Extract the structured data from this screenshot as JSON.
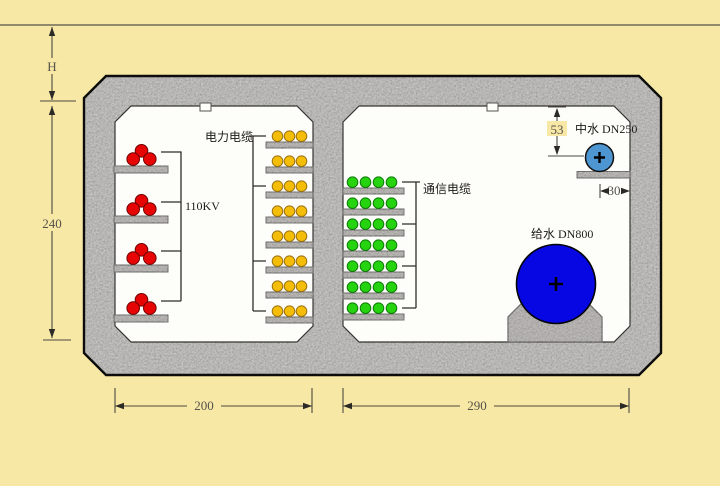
{
  "scene": {
    "type": "utility-tunnel-cross-section"
  },
  "labels": {
    "power_cables": "电力电缆",
    "hv_cables": "110KV",
    "telecom_cables": "通信电缆",
    "reclaimed_water_pipe": "中水 DN250",
    "water_supply_pipe": "给水 DN800"
  },
  "dimensions": {
    "cover_depth": "H",
    "interior_height": "240",
    "left_chamber_width": "200",
    "right_chamber_width": "290",
    "reclaimed_pipe_top_offset": "53",
    "reclaimed_pipe_side_offset": "30"
  },
  "cables": {
    "hv_110kv": {
      "shelf_count": 4,
      "cables_per_shelf": 3,
      "color": "#e60404",
      "edge": "#6e0202"
    },
    "power": {
      "shelf_count": 8,
      "cables_per_shelf": 3,
      "color": "#f4be08",
      "edge": "#9a7010"
    },
    "telecom": {
      "shelf_count": 7,
      "cables_per_shelf": 4,
      "color": "#25d40e",
      "edge": "#0e7a08"
    }
  },
  "pipes": {
    "reclaimed": {
      "color": "#4e96d2"
    },
    "supply": {
      "color": "#0607e2"
    }
  },
  "colors": {
    "background": "#f8e8a6",
    "concrete": "#b4b0ac",
    "interior": "#fdfdfa",
    "outline": "#0c0c0c"
  }
}
